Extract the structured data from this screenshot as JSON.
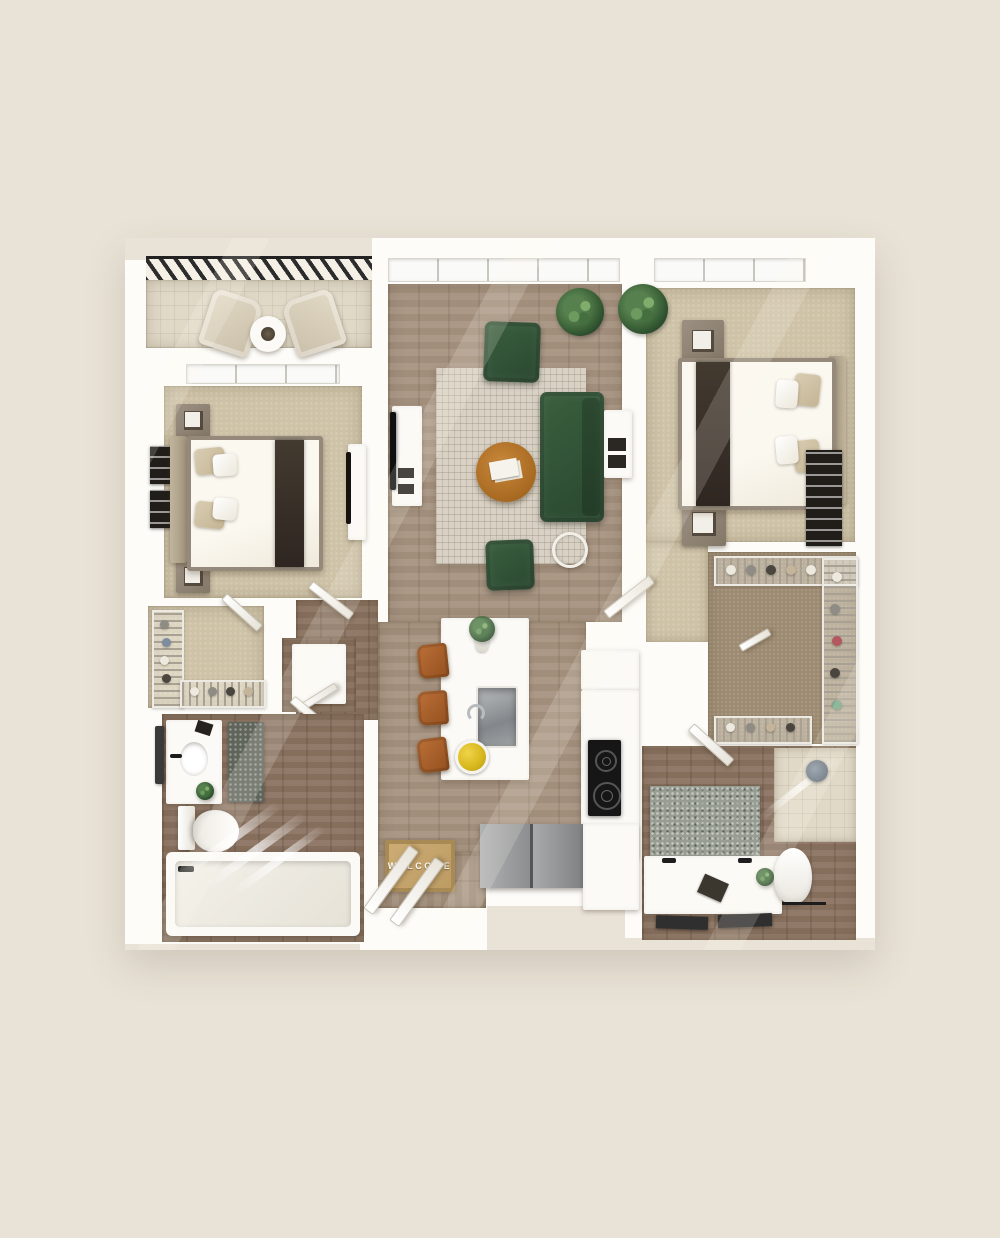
{
  "scene": {
    "type": "3d-top-down-floor-plan",
    "layout_summary": "two-bedroom two-bathroom apartment with balcony, open living-kitchen area, two walk-in closets, utility closets and entry",
    "welcome_mat": {
      "text": "WELCOME"
    }
  },
  "palette": {
    "background": "#e9e3d7",
    "wall": "#fdfcf9",
    "carpet": "#cec2a7",
    "carpet_dark": "#9c8a71",
    "wood": "#a6927f",
    "wood_dark": "#8b7361",
    "rug": "#d8d1c4",
    "sofa_green": "#2e4f33",
    "coffee_table": "#b4722d",
    "stool_leather": "#a8622f",
    "mat_tan": "#c6a36d",
    "bed_accent": "#38302a",
    "cooktop_black": "#161616",
    "lemon_yellow": "#e4c430",
    "showerhead_gray": "#5f6b78"
  },
  "rooms": [
    {
      "id": "balcony",
      "items": [
        "lounge-chair",
        "lounge-chair",
        "round-side-table"
      ]
    },
    {
      "id": "bedroom-1",
      "items": [
        "queen-bed",
        "nightstand",
        "nightstand",
        "wall-art",
        "wall-art",
        "dresser-tv"
      ]
    },
    {
      "id": "living-room",
      "items": [
        "area-rug",
        "sofa",
        "armchair",
        "armchair",
        "coffee-table",
        "side-table",
        "media-console-tv",
        "plant"
      ]
    },
    {
      "id": "bedroom-2",
      "items": [
        "queen-bed",
        "nightstand",
        "nightstand",
        "wall-art",
        "desk",
        "plant"
      ]
    },
    {
      "id": "kitchen",
      "items": [
        "island-with-sink",
        "bar-stool",
        "bar-stool",
        "bar-stool",
        "cooktop",
        "refrigerator",
        "counter",
        "lemon-bowl",
        "vase"
      ]
    },
    {
      "id": "walk-in-closet-1",
      "items": [
        "wire-shelving",
        "shoes"
      ]
    },
    {
      "id": "walk-in-closet-2",
      "items": [
        "wire-shelving",
        "hanging-clothes",
        "shoes"
      ]
    },
    {
      "id": "bathroom-1",
      "items": [
        "vanity-sink",
        "toilet",
        "bathtub",
        "bath-rug",
        "towel"
      ]
    },
    {
      "id": "bathroom-2",
      "items": [
        "double-vanity",
        "toilet",
        "walk-in-shower",
        "bath-rug",
        "mirrors"
      ]
    },
    {
      "id": "utility",
      "items": [
        "washer-closet",
        "linen-closet-basket",
        "water-heater"
      ]
    },
    {
      "id": "entry",
      "items": [
        "welcome-mat",
        "double-door"
      ]
    }
  ],
  "counts": {
    "bedrooms": 2,
    "bathrooms": 2,
    "bar_stools": 3,
    "green_armchairs": 2,
    "balcony_chairs": 2
  }
}
